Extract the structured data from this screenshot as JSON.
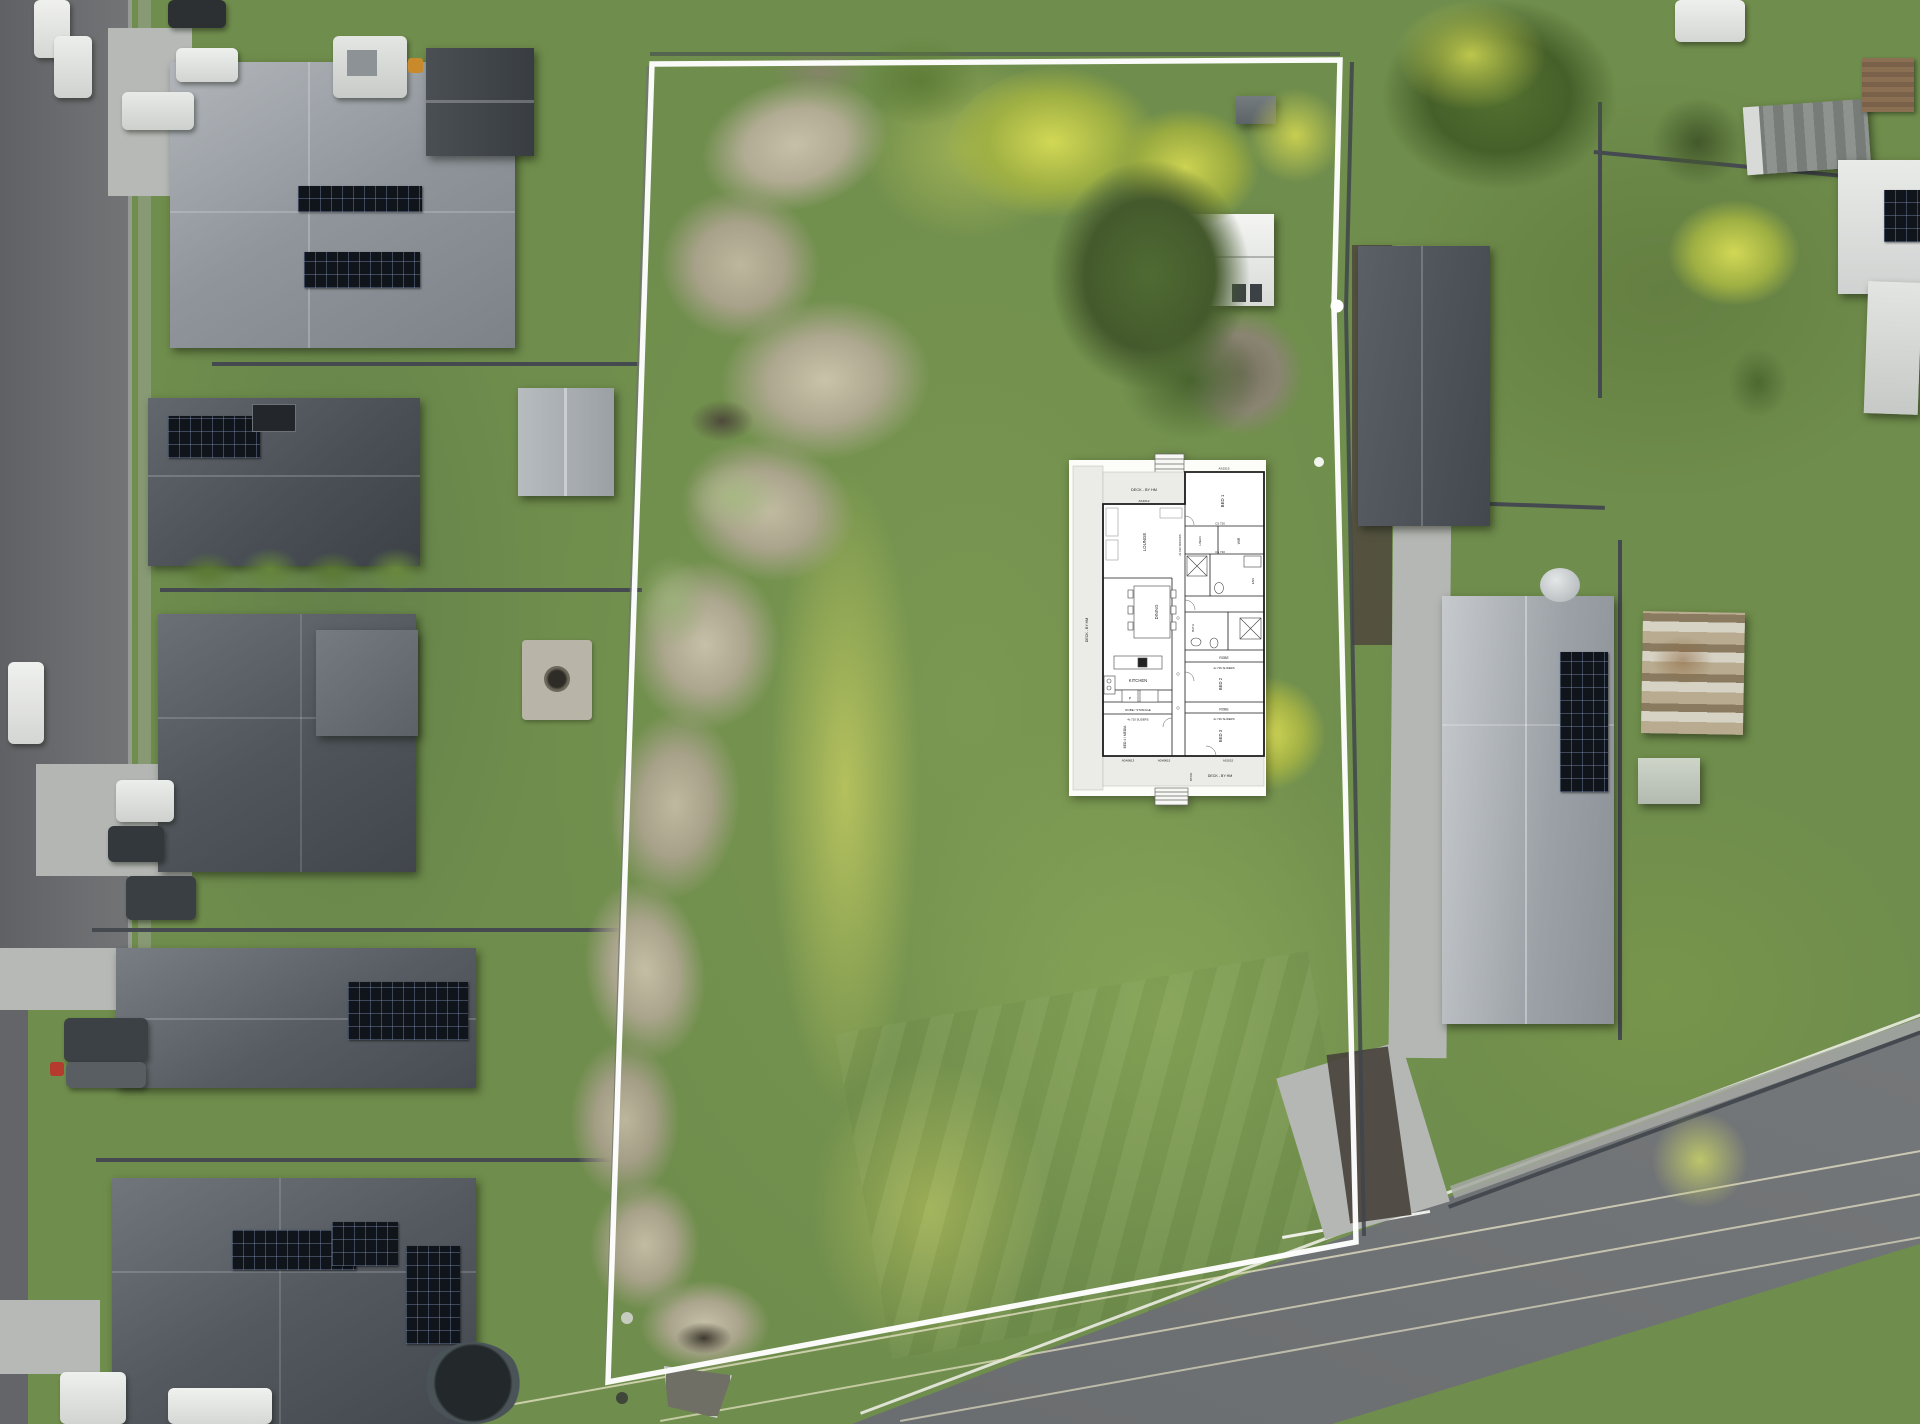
{
  "image": {
    "width": 1920,
    "height": 1424,
    "kind": "aerial drone photo of vacant lot with surveyed boundary outline and floor plan overlay"
  },
  "palette": {
    "grass": "#6f8d4c",
    "grass_dark": "#5b7a3d",
    "grass_light": "#8fae5b",
    "grass_yellow": "#c9cf62",
    "dead_grass": "#b5af97",
    "roof_light": "#a3a8ae",
    "roof_dark": "#4a5056",
    "concrete": "#b6b9b5",
    "asphalt": "#67696b",
    "boundary_white": "#ffffff",
    "fence_dark": "#454a50",
    "solar_dark": "#10141b",
    "tree_dark": "#4f6b33",
    "tree_yellow": "#d2d855",
    "plan_paper": "#fcfcf9",
    "plan_wall": "#1b1b1b",
    "plan_deck": "#ebebe7"
  },
  "floor_plan": {
    "deck_label": "DECK - BY HM",
    "patio": "PATIO",
    "rooms": {
      "lounge": "LOUNGE",
      "dining": "DINING",
      "kitchen": "KITCHEN",
      "pantry": "P",
      "robe_storage": "ROBE / STORAGE",
      "bed1": "BED 1",
      "bed2": "BED 2",
      "bed3": "BED 3",
      "bed4": "BED 4 / MEDIA",
      "linen": "LINEN",
      "wir": "WIR",
      "ens": "ENS",
      "bath": "BATH",
      "robe": "ROBE"
    },
    "codes": {
      "as1515": "AS1515",
      "as1012": "AS1012",
      "as1015": "AS1015",
      "adh0613": "ADH0613",
      "adh0615": "ADH0615",
      "cs720": "CS 720",
      "sliders": "4x 720 SLIDERS",
      "sdoors": "2x 610 SDOORS"
    }
  }
}
